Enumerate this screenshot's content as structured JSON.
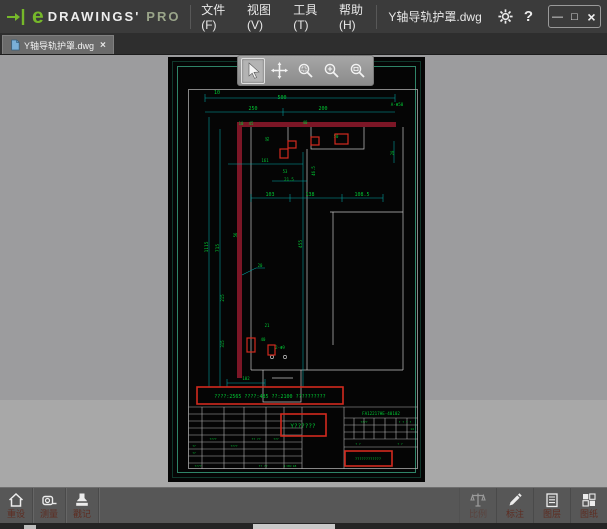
{
  "titlebar": {
    "logo": {
      "e": "e",
      "name": "DRAWINGS'",
      "tier": "PRO"
    },
    "menus": [
      {
        "label": "文件(F)"
      },
      {
        "label": "视图(V)"
      },
      {
        "label": "工具(T)"
      },
      {
        "label": "帮助(H)"
      }
    ],
    "filename": "Y轴导轨护罩.dwg",
    "help": "?",
    "window_controls": {
      "minimize": "—",
      "maximize": "□",
      "close": "×"
    }
  },
  "tabbar": {
    "tab": {
      "label": "Y轴导轨护罩.dwg",
      "close": "×"
    }
  },
  "view_toolbar": {
    "tools": [
      {
        "name": "select",
        "active": true
      },
      {
        "name": "pan",
        "active": false
      },
      {
        "name": "zoom-window",
        "active": false
      },
      {
        "name": "zoom",
        "active": false
      },
      {
        "name": "zoom-fit",
        "active": false
      }
    ]
  },
  "bottom_toolbar": {
    "left": [
      {
        "label": "重设",
        "icon": "home"
      },
      {
        "label": "测量",
        "icon": "measure"
      },
      {
        "label": "戳记",
        "icon": "stamp"
      }
    ],
    "right": [
      {
        "label": "比例",
        "icon": "scale",
        "disabled": true
      },
      {
        "label": "标注",
        "icon": "pencil",
        "disabled": false
      },
      {
        "label": "图层",
        "icon": "layers",
        "disabled": false
      },
      {
        "label": "图纸",
        "icon": "sheets",
        "disabled": false
      }
    ]
  },
  "drawing": {
    "part_number": "FA12217HE-40102",
    "part_number_pos": {
      "x": 213,
      "y": 358
    },
    "dimensions": [
      {
        "t": "10",
        "x": 49,
        "y": 37
      },
      {
        "t": "500",
        "x": 114,
        "y": 42
      },
      {
        "t": "250",
        "x": 85,
        "y": 53
      },
      {
        "t": "200",
        "x": 155,
        "y": 53
      },
      {
        "t": "A-Φ50",
        "x": 229,
        "y": 49,
        "s": 4.2
      },
      {
        "t": "10",
        "x": 73,
        "y": 68,
        "s": 4
      },
      {
        "t": "45",
        "x": 83,
        "y": 68,
        "s": 4
      },
      {
        "t": "40",
        "x": 137,
        "y": 67,
        "s": 4
      },
      {
        "t": "95",
        "x": 101,
        "y": 82,
        "r": -90,
        "s": 4
      },
      {
        "t": "50",
        "x": 168,
        "y": 81,
        "s": 4
      },
      {
        "t": "20",
        "x": 226,
        "y": 96,
        "r": -90,
        "s": 4
      },
      {
        "t": "161",
        "x": 97,
        "y": 105,
        "s": 4
      },
      {
        "t": "46.5",
        "x": 147,
        "y": 114,
        "r": -90,
        "s": 4
      },
      {
        "t": "53",
        "x": 117,
        "y": 116,
        "s": 4
      },
      {
        "t": "21.5",
        "x": 121,
        "y": 124,
        "s": 4
      },
      {
        "t": "103",
        "x": 102,
        "y": 139
      },
      {
        "t": "138",
        "x": 142,
        "y": 139
      },
      {
        "t": "108.5",
        "x": 194,
        "y": 139
      },
      {
        "t": "1115",
        "x": 40,
        "y": 190,
        "r": -90,
        "s": 4.5
      },
      {
        "t": "715",
        "x": 51,
        "y": 191,
        "r": -90,
        "s": 4.5
      },
      {
        "t": "56",
        "x": 69,
        "y": 178,
        "r": -90,
        "s": 4
      },
      {
        "t": "455",
        "x": 134,
        "y": 187,
        "r": -90,
        "s": 4.5
      },
      {
        "t": "20",
        "x": 92,
        "y": 210,
        "s": 4
      },
      {
        "t": "215",
        "x": 56,
        "y": 241,
        "r": -90,
        "s": 4
      },
      {
        "t": "315",
        "x": 56,
        "y": 287,
        "r": -90,
        "s": 4
      },
      {
        "t": "21",
        "x": 99,
        "y": 270,
        "s": 4
      },
      {
        "t": "40",
        "x": 95,
        "y": 284,
        "s": 4
      },
      {
        "t": "2-Φ9",
        "x": 112,
        "y": 292,
        "s": 4
      },
      {
        "t": "102",
        "x": 78,
        "y": 323,
        "s": 4
      },
      {
        "t": "????",
        "x": 45,
        "y": 383,
        "s": 3
      },
      {
        "t": "?? ??",
        "x": 88,
        "y": 383,
        "s": 3
      },
      {
        "t": "???",
        "x": 108,
        "y": 383,
        "s": 3
      },
      {
        "t": "??",
        "x": 26,
        "y": 390,
        "s": 3
      },
      {
        "t": "????",
        "x": 66,
        "y": 390,
        "s": 3
      },
      {
        "t": "??",
        "x": 26,
        "y": 397,
        "s": 3
      },
      {
        "t": "????",
        "x": 30,
        "y": 410,
        "s": 3
      },
      {
        "t": "?? ??",
        "x": 95,
        "y": 410,
        "s": 3
      },
      {
        "t": "1:06:18",
        "x": 122,
        "y": 410,
        "s": 3
      },
      {
        "t": "????",
        "x": 196,
        "y": 366,
        "s": 3
      },
      {
        "t": "? ? ? ?",
        "x": 237,
        "y": 366,
        "s": 3
      },
      {
        "t": "14",
        "x": 244,
        "y": 373,
        "s": 3
      },
      {
        "t": "? ?",
        "x": 190,
        "y": 388,
        "s": 3
      },
      {
        "t": "? ?",
        "x": 232,
        "y": 388,
        "s": 3
      }
    ],
    "markup_boxes": [
      {
        "x": 29,
        "y": 330,
        "w": 146,
        "h": 17,
        "text": "????:2565 ????:485 ??:2100 ??????????",
        "ts": 5,
        "tx": 102,
        "ty": 341
      },
      {
        "x": 113,
        "y": 357,
        "w": 45,
        "h": 22,
        "text": "Y??????",
        "ts": 6,
        "tx": 135,
        "ty": 371
      },
      {
        "x": 177,
        "y": 394,
        "w": 47,
        "h": 15,
        "text": "????????????",
        "ts": 3.6,
        "tx": 200,
        "ty": 403
      }
    ],
    "highlight_boxes": [
      {
        "x": 167,
        "y": 77,
        "w": 13,
        "h": 10
      },
      {
        "x": 143,
        "y": 80,
        "w": 8,
        "h": 8
      },
      {
        "x": 112,
        "y": 92,
        "w": 8,
        "h": 9
      },
      {
        "x": 120,
        "y": 84,
        "w": 8,
        "h": 7
      },
      {
        "x": 79,
        "y": 281,
        "w": 8,
        "h": 14
      },
      {
        "x": 100,
        "y": 288,
        "w": 7,
        "h": 10
      }
    ]
  },
  "colors": {
    "accent_green": "#76b82a",
    "dim_line": "#00a8a8",
    "dim_text": "#00c833",
    "markup_red": "#d22a1e",
    "part_maroon": "#7c1626",
    "frame_green": "#2f8468",
    "sheet_bg": "#050505"
  }
}
